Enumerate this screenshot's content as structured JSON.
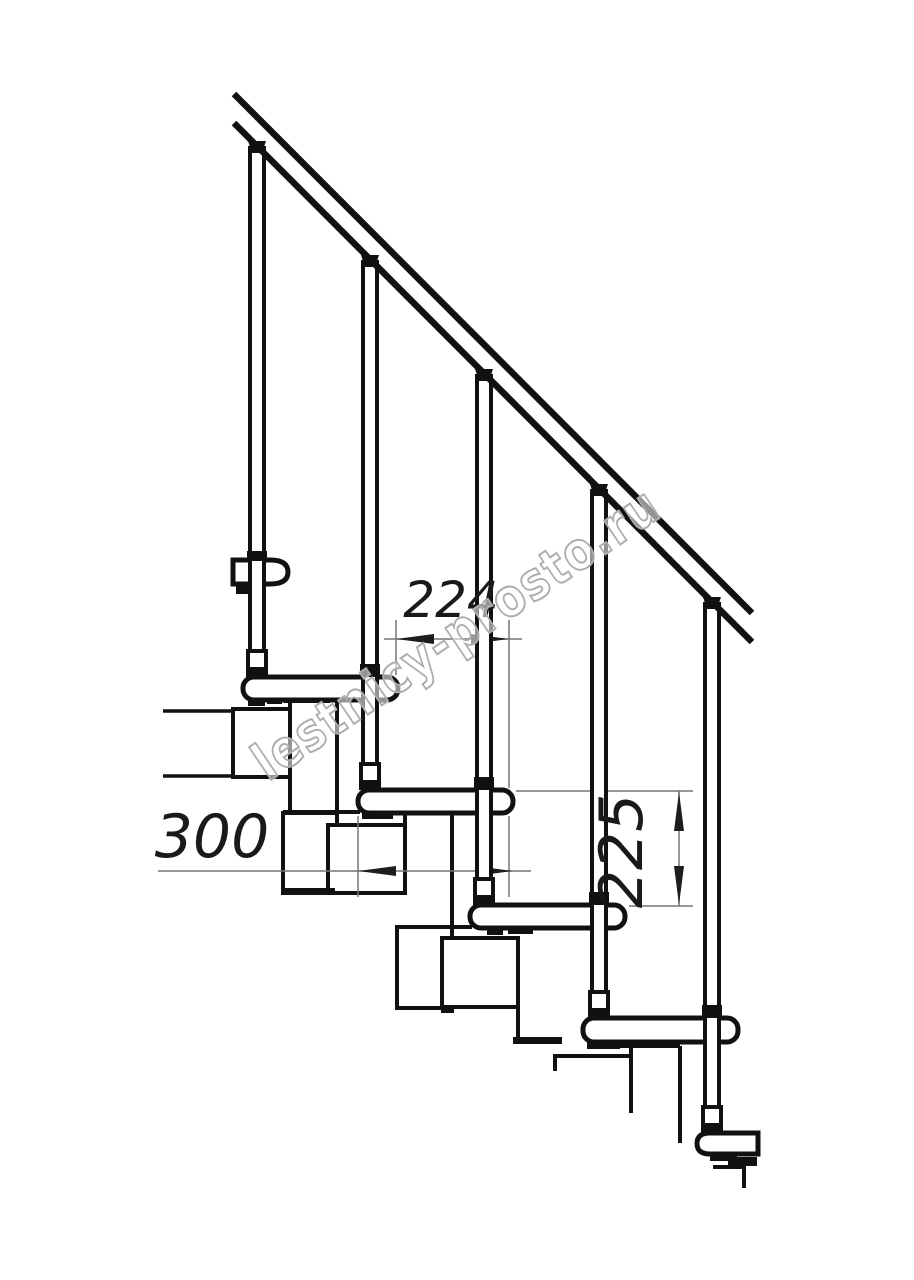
{
  "page": {
    "title": "Modular staircase side elevation drawing",
    "background": "#ffffff"
  },
  "drawing": {
    "type": "technical-diagram",
    "subject": "modular staircase with handrail, balusters and treads, side view",
    "dimensions": {
      "step_run": "224",
      "tread_length": "300",
      "step_rise": "225"
    },
    "watermark": {
      "text": "lestnicy-prosto.ru"
    },
    "colors": {
      "line": "#111111",
      "dimension_line": "#757575",
      "arrow": "#1d1d1d",
      "dimension_text": "#1a1a1a",
      "watermark_stroke": "#adadad"
    }
  }
}
